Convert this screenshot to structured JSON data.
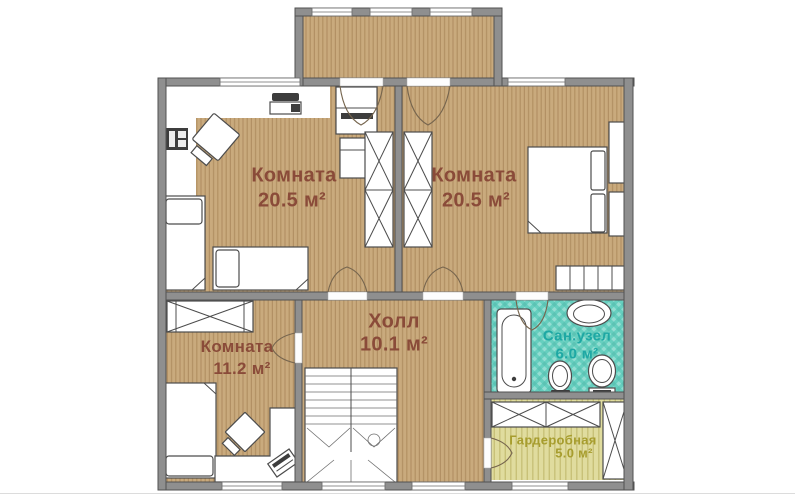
{
  "plan_title": "Floor plan",
  "rooms": [
    {
      "id": "room-top-left",
      "name": "Комната",
      "area": "20.5 м²"
    },
    {
      "id": "room-top-right",
      "name": "Комната",
      "area": "20.5 м²"
    },
    {
      "id": "room-bottom-left",
      "name": "Комната",
      "area": "11.2 м²"
    },
    {
      "id": "hall",
      "name": "Холл",
      "area": "10.1 м²"
    },
    {
      "id": "bathroom",
      "name": "Сан.узел",
      "area": "6.0 м²"
    },
    {
      "id": "wardrobe-room",
      "name": "Гардеробная",
      "area": "5.0 м²"
    }
  ],
  "colors": {
    "wood_floor": "#c9aa7d",
    "wood_stripe": "#b29063",
    "wall": "#8f8f8f",
    "wall_edge": "#525252",
    "bathroom_tile": "#66cfbf",
    "bathroom_label": "#1ea8a4",
    "wardrobe_floor": "#e0dc9e",
    "wardrobe_stripe": "#c8c178",
    "wardrobe_label": "#a79d2e",
    "room_label": "#8a4b39",
    "furniture_outline": "#4c4c4c"
  }
}
